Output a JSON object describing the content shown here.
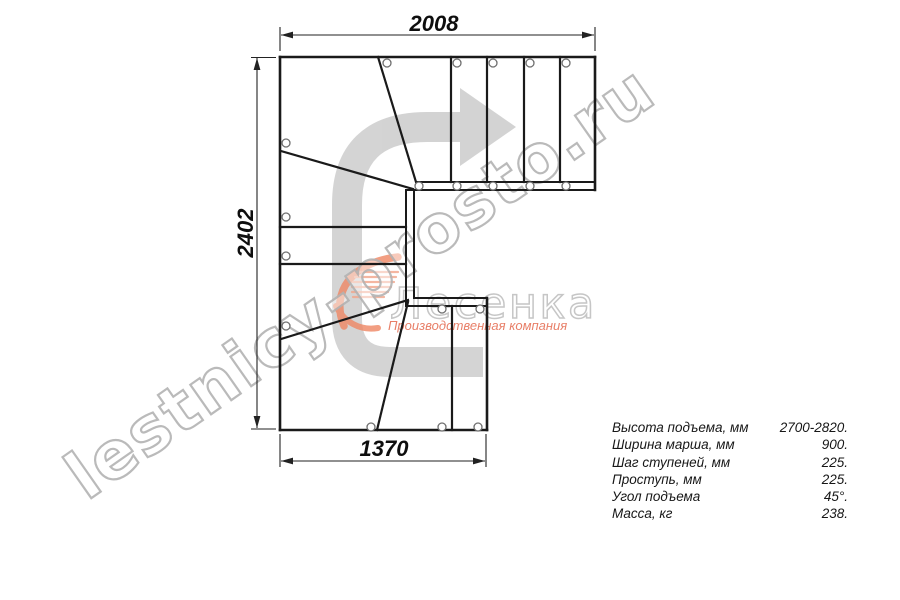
{
  "window": {
    "width": 900,
    "height": 600,
    "background": "#ffffff"
  },
  "drawing": {
    "type": "staircase-plan-view-180-turn-with-winders",
    "dimensions_mm": {
      "top": "2008",
      "left": "2402",
      "bottom": "1370"
    }
  },
  "specs": {
    "rows": [
      {
        "label": "Высота подъема, мм",
        "value": "2700-2820."
      },
      {
        "label": "Ширина марша, мм",
        "value": "900."
      },
      {
        "label": "Шаг ступеней, мм",
        "value": "225."
      },
      {
        "label": "Проступь, мм",
        "value": "225."
      },
      {
        "label": "Угол подъема",
        "value": "45°."
      },
      {
        "label": "Масса, кг",
        "value": "238."
      }
    ]
  },
  "watermark": {
    "text": "lestnicy-prosto.ru"
  },
  "logo": {
    "brand": "Лесенка",
    "tagline": "Производственная компания"
  },
  "colors": {
    "line": "#1a1a1a",
    "dimension": "#222222",
    "dimension_text": "#0e0e0e",
    "screw_circle": "#6f6f6f",
    "arrow_grey": "#c9c9c9",
    "watermark_grey": "#b3b3b3",
    "logo_orange": "#ef8764",
    "logo_tagline_orange": "#e4694e",
    "logo_brand_grey": "#c6c6c6"
  }
}
